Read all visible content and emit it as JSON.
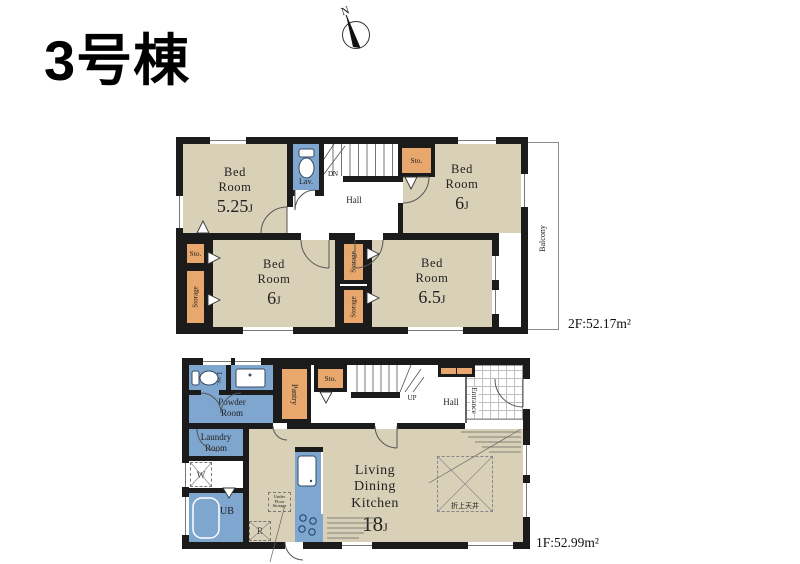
{
  "title": "3号棟",
  "compass_label": "N",
  "floor2": {
    "area_label": "2F:52.17m²",
    "bedroom_nw": {
      "name": "Bed\nRoom",
      "size": "5.25",
      "unit": "J"
    },
    "bedroom_ne": {
      "name": "Bed\nRoom",
      "size": "6",
      "unit": "J"
    },
    "bedroom_sw": {
      "name": "Bed\nRoom",
      "size": "6",
      "unit": "J"
    },
    "bedroom_se": {
      "name": "Bed\nRoom",
      "size": "6.5",
      "unit": "J"
    },
    "hall_label": "Hall",
    "lav_label": "Lav.",
    "stairs_label": "DN",
    "sto_top_label": "Sto.",
    "sto_left_label": "Sto.",
    "storage_left_label": "Storage",
    "storage_mid_top_label": "Storage",
    "storage_mid_bottom_label": "Storage",
    "balcony_label": "Balcony"
  },
  "floor1": {
    "area_label": "1F:52.99m²",
    "ldk": {
      "name": "Living\nDining\nKitchen",
      "size": "18",
      "unit": "J"
    },
    "lav_label": "Lav.",
    "powder_label": "Powder\nRoom",
    "laundry_label": "Laundry\nRoom",
    "washer_label": "W",
    "bath_label": "UB",
    "fridge_label": "R",
    "pantry_label": "Pantry",
    "sto_label": "Sto.",
    "stairs_label": "UP",
    "hall_label": "Hall",
    "entrance_label": "Entrance",
    "underfloor_label": "Under\nFloor\nStorage",
    "ceiling_label": "折上天井"
  }
}
